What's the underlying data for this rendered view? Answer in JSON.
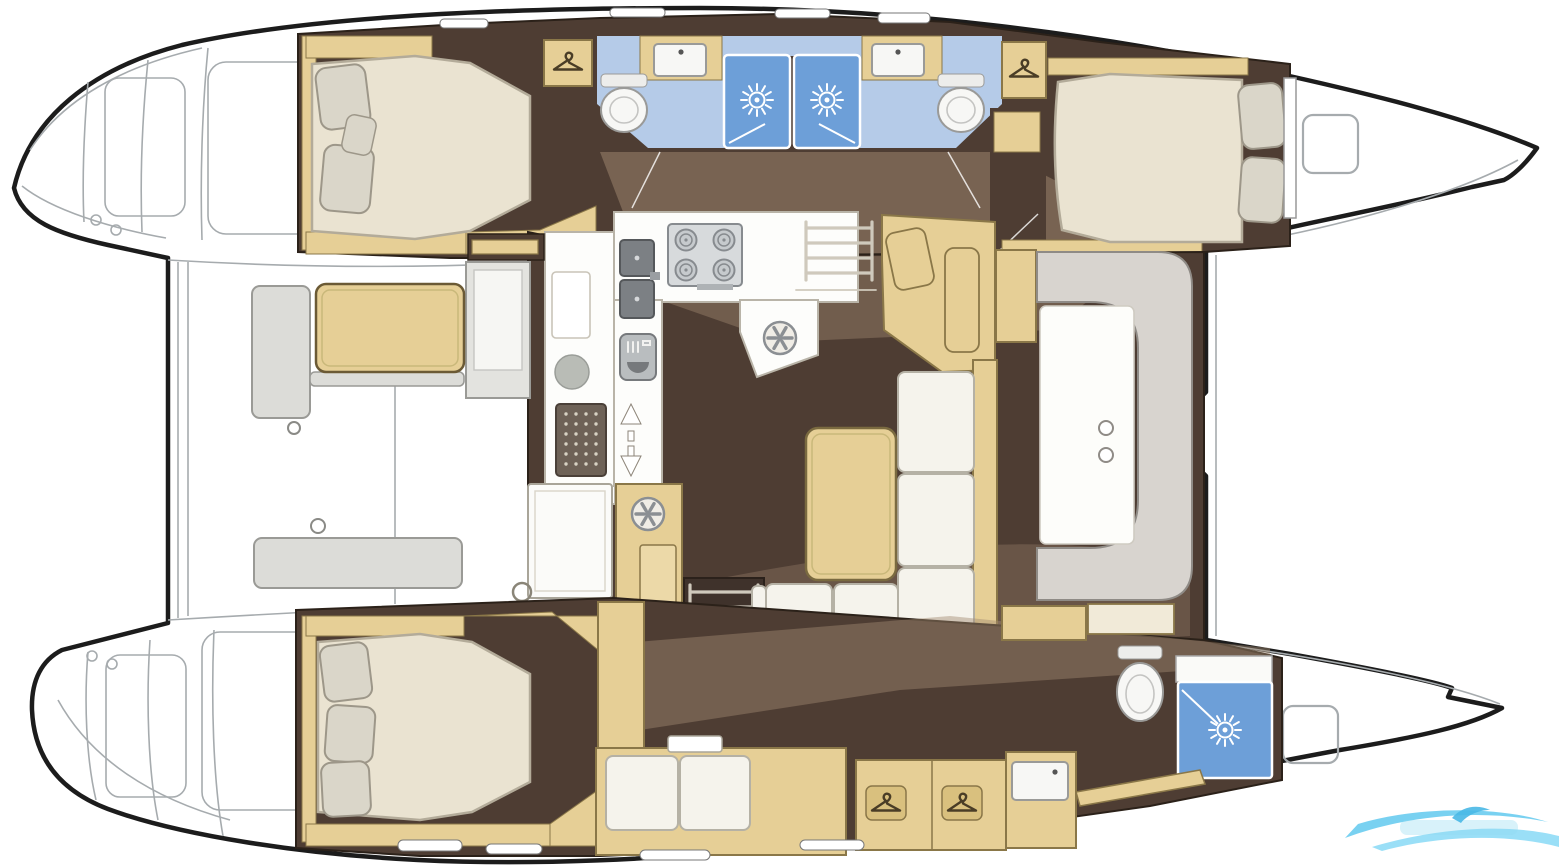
{
  "meta": {
    "kind": "boat-floorplan-diagram",
    "subject": "catamaran interior layout, top-down view",
    "orientation": {
      "bow": "right",
      "stern": "left"
    },
    "visible_text": "none (watermark text illegible)"
  },
  "palette": {
    "outline": "#1c1c1c",
    "thin": "#a6abae",
    "floor": "#4e3d33",
    "floor-light": "#a18a72",
    "wood": "#e6cf96",
    "wood-border": "#8a7748",
    "wood-dark": "#6b5a35",
    "mattress": "#eae3d1",
    "mattress-border": "#b3ab99",
    "pillow": "#dad6c9",
    "pillow-border": "#9d9789",
    "cushion": "#f5f3ec",
    "cushion-border": "#b5b1a5",
    "bath": "#b5cbe8",
    "shower": "#6d9fd8",
    "fixture": "#f7f7f5",
    "fixture-border": "#9a9a98",
    "steel": "#d7dadc",
    "steel-border": "#878b8f",
    "sinkdark": "#7c8084",
    "stairs": "#3f322b",
    "rail": "#cfc9bc",
    "graybench": "#dcdcd8",
    "graybench-border": "#9a9a96",
    "watermark": "#62c9ef"
  },
  "rooms": {
    "port_aft_cabin": {
      "name": "port aft double cabin"
    },
    "port_bathrooms": {
      "name": "two back-to-back bathrooms with showers"
    },
    "port_fwd_cabin": {
      "name": "port forward double cabin"
    },
    "salon": {
      "name": "bridgedeck salon with galley, L-sofa, table and curved front settee"
    },
    "stbd_aft_cabin": {
      "name": "starboard aft double cabin"
    },
    "stbd_corridor": {
      "name": "starboard hull passage with settee and wardrobes"
    },
    "stbd_bathroom": {
      "name": "starboard forward bathroom with shower"
    },
    "cockpit": {
      "name": "aft cockpit with table and benches"
    },
    "foredeck": {
      "name": "foredeck and bows"
    }
  },
  "inventory": {
    "double_beds": 3,
    "shower_stalls": 3,
    "toilets": 3,
    "bathroom_sinks": 3,
    "galley_sinks": 2,
    "stove_burners": 4,
    "hanger_lockers": 4,
    "companionway_stairs": 2,
    "deck_hatches": 2
  },
  "icons": [
    "hanger-icon",
    "shower-sun-icon",
    "vent-wheel-icon",
    "burner-icon",
    "oven-icon",
    "updown-arrows-icon",
    "leftright-arrows-icon",
    "wave-logo-watermark"
  ],
  "watermark": {
    "present": true,
    "position": "bottom-right",
    "color": "#62c9ef"
  }
}
